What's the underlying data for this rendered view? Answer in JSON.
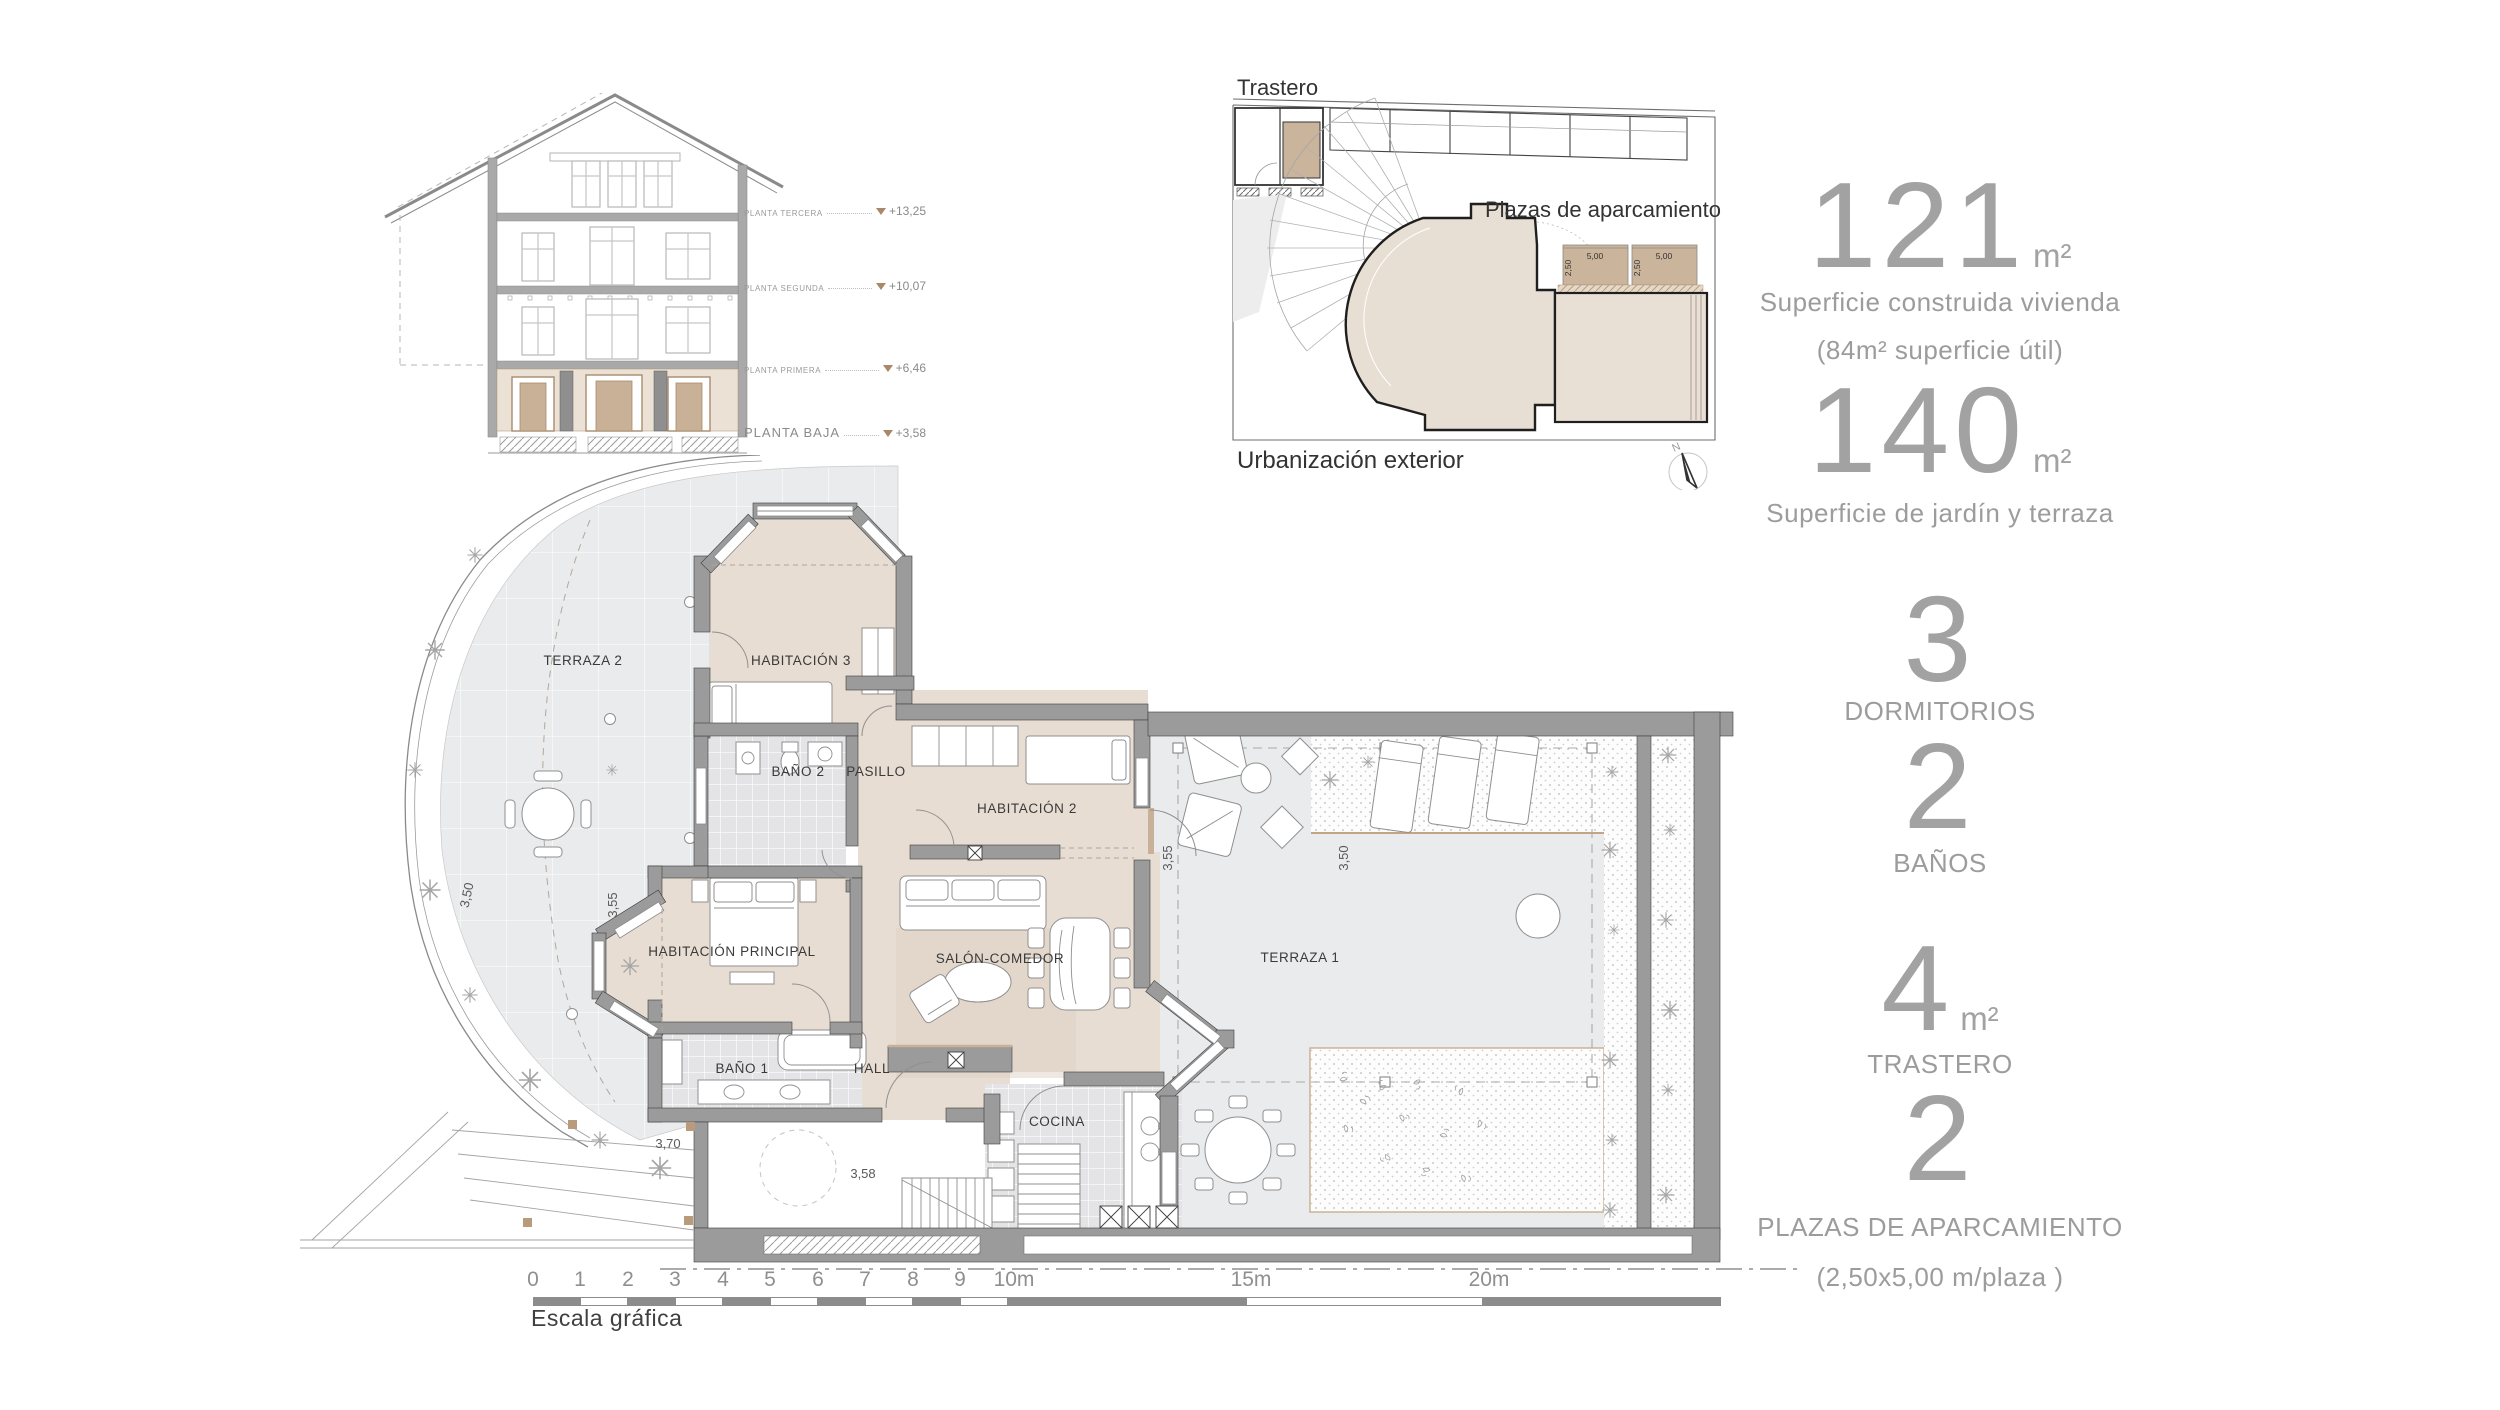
{
  "section": {
    "levels": [
      {
        "label": "PLANTA TERCERA",
        "elevation": "+13,25"
      },
      {
        "label": "PLANTA SEGUNDA",
        "elevation": "+10,07"
      },
      {
        "label": "PLANTA PRIMERA",
        "elevation": "+6,46"
      },
      {
        "label": "PLANTA BAJA",
        "elevation": "+3,58"
      }
    ]
  },
  "site_plan": {
    "trastero_label": "Trastero",
    "parking_label": "Plazas de aparcamiento",
    "exterior_label": "Urbanización exterior",
    "north_label": "N",
    "parking_stall": {
      "width": "5,00",
      "depth": "2,50"
    }
  },
  "stats": [
    {
      "value": "121",
      "unit": "m²",
      "lines": [
        "Superficie construida vivienda",
        "(84m² superficie útil)"
      ]
    },
    {
      "value": "140",
      "unit": "m²",
      "lines": [
        "Superficie de jardín y terraza"
      ]
    },
    {
      "value": "3",
      "unit": "",
      "lines": [
        "DORMITORIOS"
      ]
    },
    {
      "value": "2",
      "unit": "",
      "lines": [
        "BAÑOS"
      ]
    },
    {
      "value": "4",
      "unit": "m²",
      "lines": [
        "TRASTERO"
      ]
    },
    {
      "value": "2",
      "unit": "",
      "lines": [
        "PLAZAS DE APARCAMIENTO",
        "(2,50x5,00 m/plaza )"
      ]
    }
  ],
  "floor_plan": {
    "rooms": [
      {
        "label": "TERRAZA 2"
      },
      {
        "label": "HABITACIÓN 3"
      },
      {
        "label": "BAÑO 2"
      },
      {
        "label": "PASILLO"
      },
      {
        "label": "HABITACIÓN 2"
      },
      {
        "label": "HABITACIÓN PRINCIPAL"
      },
      {
        "label": "SALÓN-COMEDOR"
      },
      {
        "label": "TERRAZA 1"
      },
      {
        "label": "BAÑO 1"
      },
      {
        "label": "HALL"
      },
      {
        "label": "COCINA"
      }
    ],
    "dimensions": [
      {
        "id": "terraza2-depth",
        "value": "3,50"
      },
      {
        "id": "habitacion-principal-bay",
        "value": "3,55"
      },
      {
        "id": "terraza1-pergola-left",
        "value": "3,55"
      },
      {
        "id": "terraza1-pergola-right",
        "value": "3,50"
      },
      {
        "id": "rampa",
        "value": "3,70"
      },
      {
        "id": "acceso",
        "value": "3,58"
      }
    ]
  },
  "scale_bar": {
    "ticks": [
      "0",
      "1",
      "2",
      "3",
      "4",
      "5",
      "6",
      "7",
      "8",
      "9",
      "10m",
      "15m",
      "20m"
    ],
    "label": "Escala gráfica"
  },
  "colors": {
    "wall": "#9b9b9b",
    "floor_beige": "#e7ddd2",
    "accent_tan": "#c9b098",
    "terrace_gray": "#e9ebec",
    "tile_gray": "#e4e4e7",
    "stats_text": "#9e9e9e"
  }
}
